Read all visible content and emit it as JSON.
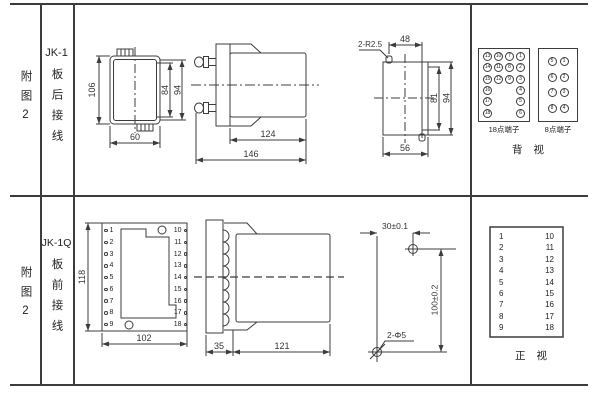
{
  "row1": {
    "figure": "附图2",
    "model": "JK-1",
    "wiring": "板后接线"
  },
  "row2": {
    "figure": "附图2",
    "model": "JK-1Q",
    "wiring": "板前接线"
  },
  "rear_view": {
    "height": "106",
    "inner_height": "84",
    "terminal_height": "94",
    "width": "60"
  },
  "side_view": {
    "body_length": "124",
    "total_length": "146"
  },
  "cutout": {
    "corner_label": "2-R2.5",
    "top_width": "48",
    "inner_height": "81",
    "outer_height": "94",
    "bottom_width": "56"
  },
  "back_panel": {
    "terminals_18": [
      "13",
      "10",
      "7",
      "1",
      "14",
      "11",
      "8",
      "2",
      "15",
      "12",
      "9",
      "3",
      "16",
      "",
      "",
      "4",
      "17",
      "",
      "",
      "5",
      "18",
      "",
      "",
      "6"
    ],
    "terminals_8": [
      "5",
      "1",
      "6",
      "2",
      "7",
      "3",
      "8",
      "4"
    ],
    "label_18": "18点端子",
    "label_8": "8点端子",
    "caption": "背 视"
  },
  "front_plate": {
    "height": "118",
    "width": "102",
    "pins_left": [
      "1",
      "2",
      "3",
      "4",
      "5",
      "6",
      "7",
      "8",
      "9"
    ],
    "pins_right": [
      "10",
      "11",
      "12",
      "13",
      "14",
      "15",
      "16",
      "17",
      "18"
    ]
  },
  "side_view_front": {
    "plate_depth": "35",
    "body_length": "121"
  },
  "drill_plan": {
    "horizontal": "30±0.1",
    "vertical": "100±0.2",
    "holes": "2-Φ5"
  },
  "front_panel": {
    "left": [
      "1",
      "2",
      "3",
      "4",
      "5",
      "6",
      "7",
      "8",
      "9"
    ],
    "right": [
      "10",
      "11",
      "12",
      "13",
      "14",
      "15",
      "16",
      "17",
      "18"
    ],
    "caption": "正 视"
  }
}
